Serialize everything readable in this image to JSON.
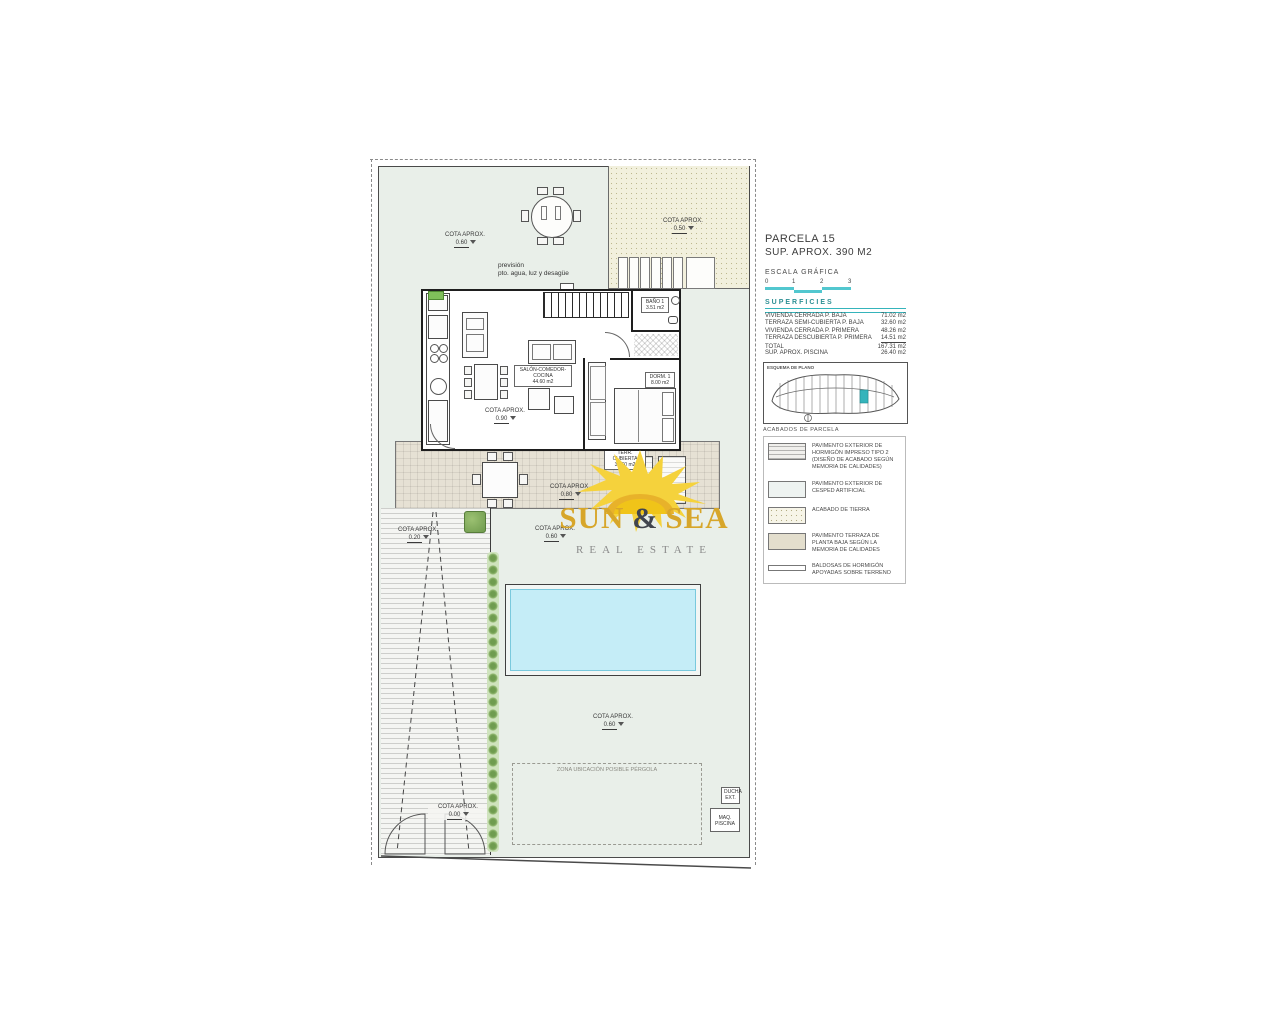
{
  "panel": {
    "parcel_title": "PARCELA 15",
    "parcel_subtitle": "SUP. APROX. 390 M2",
    "scale_title": "ESCALA GRÁFICA",
    "scale_ticks": [
      "0",
      "1",
      "2",
      "3"
    ],
    "superficies": {
      "title": "SUPERFICIES",
      "rows": [
        {
          "label": "VIVIENDA CERRADA P. BAJA",
          "value": "71.02 m2"
        },
        {
          "label": "TERRAZA SEMI-CUBIERTA P. BAJA",
          "value": "32.60 m2"
        },
        {
          "label": "VIVIENDA CERRADA P. PRIMERA",
          "value": "48.26 m2"
        },
        {
          "label": "TERRAZA DESCUBIERTA P. PRIMERA",
          "value": "14.51 m2"
        },
        {
          "label": "TOTAL",
          "value": "167.31 m2"
        }
      ],
      "pool_row": {
        "label": "SUP. APROX. PISCINA",
        "value": "26.40 m2"
      }
    },
    "keyplan_title": "ESQUEMA DE PLANO",
    "legend": {
      "title": "ACABADOS DE PARCELA",
      "items": [
        {
          "label": "PAVIMENTO EXTERIOR DE HORMIGÓN IMPRESO TIPO 2 (DISEÑO DE ACABADO SEGÚN MEMORIA DE CALIDADES)"
        },
        {
          "label": "PAVIMENTO EXTERIOR DE CESPED ARTIFICIAL"
        },
        {
          "label": "ACABADO DE TIERRA"
        },
        {
          "label": "PAVIMENTO TERRAZA DE PLANTA BAJA SEGÚN LA MEMORIA DE CALIDADES"
        },
        {
          "label": "BALDOSAS DE HORMIGÓN APOYADAS SOBRE TERRENO"
        }
      ]
    }
  },
  "plan": {
    "cotas": [
      {
        "label": "COTA APROX.",
        "value": "0.60"
      },
      {
        "label": "COTA APROX.",
        "value": "0.50"
      },
      {
        "label": "COTA APROX.",
        "value": "0.90"
      },
      {
        "label": "COTA APROX.",
        "value": "0.80"
      },
      {
        "label": "COTA APROX.",
        "value": "0.20"
      },
      {
        "label": "COTA APROX.",
        "value": "0.60"
      },
      {
        "label": "COTA APROX.",
        "value": "0.60"
      },
      {
        "label": "COTA APROX.",
        "value": "0.00"
      }
    ],
    "prevision_line1": "previsión",
    "prevision_line2": "pto. agua, luz y desagüe",
    "rooms": {
      "salon_label": "SALÓN-COMEDOR-COCINA",
      "salon_area": "44.60 m2",
      "bano_label": "BAÑO 1",
      "bano_area": "3.51 m2",
      "dorm_label": "DORM. 1",
      "dorm_area": "8.00 m2",
      "terraza_label": "TERR. CUBIERTA",
      "terraza_area": "32.60 m2"
    },
    "pergola_label": "ZONA UBICACIÓN POSIBLE PÉRGOLA",
    "ducha_label": "DUCHA EXT.",
    "maq_label": "MAQ. PISCINA"
  },
  "watermark": {
    "sun_word": "SUN",
    "amp": "&",
    "sea_word": "SEA",
    "subtitle": "REAL ESTATE"
  },
  "colors": {
    "accent_teal": "#35b4bb",
    "scale_turquoise": "#52c7cf",
    "brand_gold": "#d7a62a",
    "brand_dark": "#41454f",
    "pool_water": "#c5edf7",
    "garden_green": "#e9efe9",
    "tierra_beige": "#f2f0dd",
    "terrace_tan": "#e6e1d4"
  }
}
